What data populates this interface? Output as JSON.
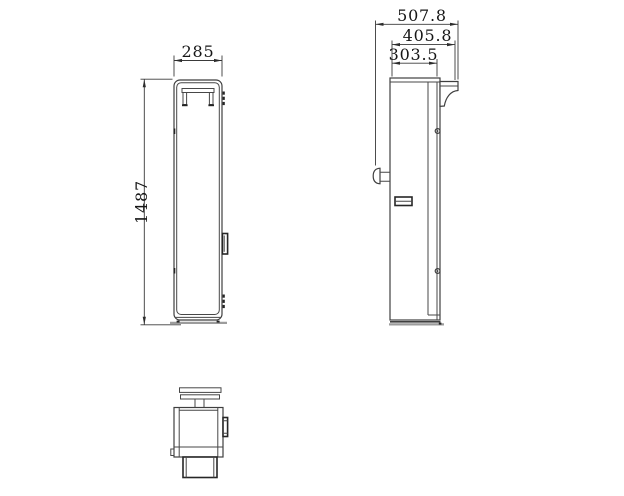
{
  "drawing": {
    "background": "#ffffff",
    "line_color": "#3f3f3f",
    "shadow_color": "#9c9c9c",
    "text_color": "#161616",
    "dimensions": {
      "front_width": "285",
      "front_height": "1487",
      "side_total_depth": "507.8",
      "side_hook_depth": "405.8",
      "side_body_depth": "303.5"
    }
  }
}
